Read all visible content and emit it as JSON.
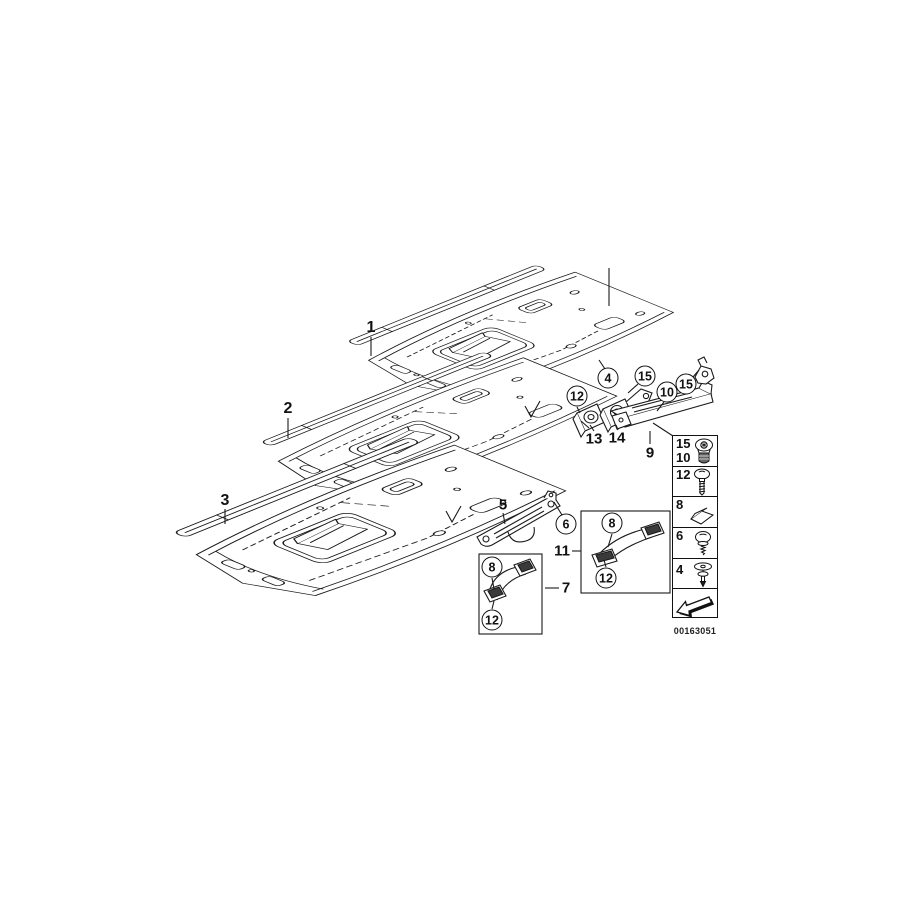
{
  "part_labels": {
    "headliner_panel_1": "1",
    "headliner_panel_2": "2",
    "headliner_panel_3": "3",
    "bracket_5": "5",
    "grab_handle_7": "7",
    "bracket_rail_9": "9",
    "grab_handle_11": "11",
    "clip_13": "13",
    "bracket_14": "14"
  },
  "callouts": {
    "fastener_4": "4",
    "screw_6": "6",
    "cover_8_box7": "8",
    "cover_8_box11": "8",
    "screw_10": "10",
    "screw_12_panel": "12",
    "screw_12_box7": "12",
    "screw_12_box11": "12",
    "screw_15_panel": "15",
    "screw_15_clip": "15"
  },
  "legend": {
    "rows": [
      {
        "numbers": [
          "15",
          "10"
        ],
        "icon": "torx-screw-icon"
      },
      {
        "numbers": [
          "12"
        ],
        "icon": "hex-screw-icon"
      },
      {
        "numbers": [
          "8"
        ],
        "icon": "adhesive-pad-icon"
      },
      {
        "numbers": [
          "6"
        ],
        "icon": "washer-screw-icon"
      },
      {
        "numbers": [
          "4"
        ],
        "icon": "expanding-rivet-icon"
      }
    ],
    "direction_arrow": "direction-arrow-icon",
    "drawing_number": "00163051"
  }
}
